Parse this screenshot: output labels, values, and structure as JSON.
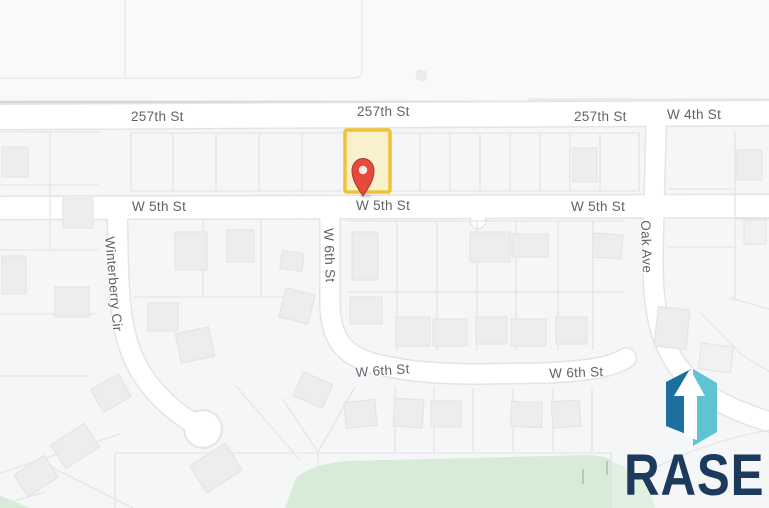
{
  "map": {
    "street_labels": [
      {
        "text": "257th St"
      },
      {
        "text": "257th St"
      },
      {
        "text": "257th St"
      },
      {
        "text": "W 4th St"
      },
      {
        "text": "W 5th St"
      },
      {
        "text": "W 5th St"
      },
      {
        "text": "W 5th St"
      },
      {
        "text": "Winterberry Cir"
      },
      {
        "text": "W 6th St"
      },
      {
        "text": "Oak Ave"
      },
      {
        "text": "W 6th St"
      },
      {
        "text": "W 6th St"
      }
    ],
    "label_color": "#5F6368",
    "road_color": "#FFFFFF",
    "park_color": "#D8EBD9",
    "highlighted_parcel": {
      "outline_color": "#F0C236",
      "fill_color": "#F8F1CC",
      "marker": "red-map-pin",
      "marker_color": "#E64A3C",
      "marker_border_color": "#A63D33",
      "marker_hole_color": "#F8EAE4"
    }
  },
  "logo": {
    "brand": "RASE",
    "icon": "rase-prism-arrow-logo",
    "colors": {
      "panel_dark": "#1C6F9F",
      "panel_light": "#5EC4D1",
      "arrow": "#FFFFFF",
      "wordmark": "#1B3A5C"
    }
  }
}
